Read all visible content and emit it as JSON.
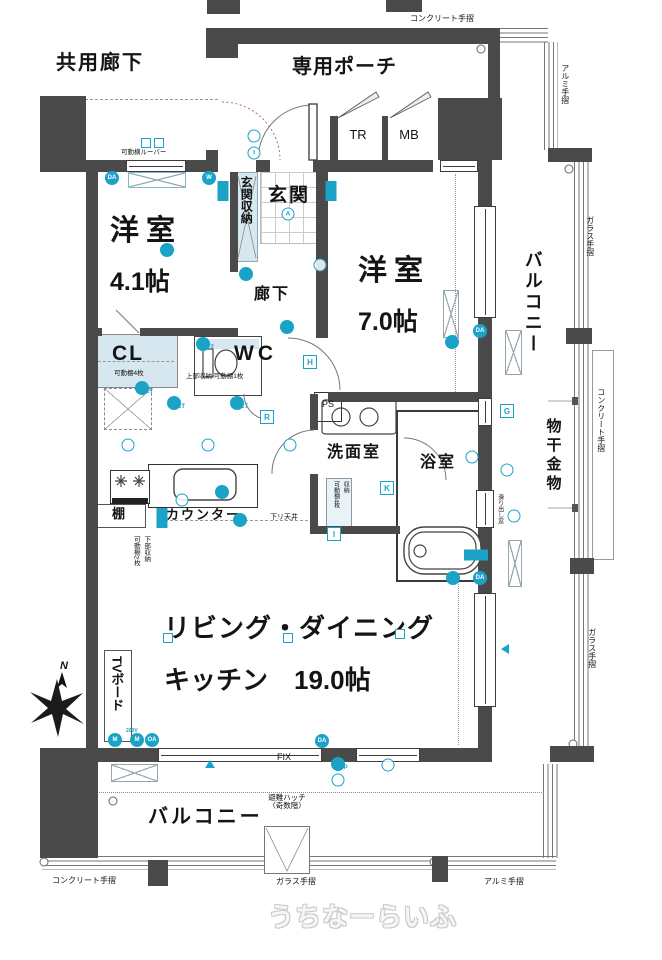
{
  "labels": {
    "shared_corridor": "共用廊下",
    "private_porch": "専用ポーチ",
    "tr": "TR",
    "mb": "MB",
    "entrance": "玄関",
    "entrance_storage": "玄関収納",
    "room1_line1": "洋室",
    "room1_line2": "4.1帖",
    "corridor": "廊下",
    "room2_line1": "洋室",
    "room2_line2": "7.0帖",
    "balcony_right": "バルコニー",
    "cl": "CL",
    "cl_note": "可動棚4枚",
    "wc": "WC",
    "wc_note": "上部収納 可動棚1枚",
    "ps": "PS",
    "washroom": "洗面室",
    "bathroom": "浴室",
    "washroom_storage": "収納\n可動棚4枚",
    "shelf": "棚",
    "counter": "カウンター",
    "dropped_ceiling": "下リ天井",
    "counter_storage": "下部収納\n可動棚2枚",
    "ldk_line1": "リビング・ダイニング",
    "ldk_line2": "キッチン　19.0帖",
    "tv_board": "TVボード",
    "balcony_bottom": "バルコニー",
    "hatch": "避難ハッチ\n（奇数階）",
    "laundry_hardware": "物干金物",
    "louver_note": "可動横ルーバー",
    "sliding_window_note": "滑り出し窓",
    "fix": "FIX",
    "v200": "200V",
    "compass_n": "N",
    "rail_concrete_top": "コンクリート手摺",
    "rail_alumi_right": "アルミ手摺",
    "rail_glass_right_upper": "ガラス手摺",
    "rail_concrete_right": "コンクリート手摺",
    "rail_glass_right_lower": "ガラス手摺",
    "rail_concrete_bottom": "コンクリート手摺",
    "rail_glass_bottom": "ガラス手摺",
    "rail_alumi_bottom": "アルミ手摺",
    "watermark": "うちなーらいふ"
  },
  "colors": {
    "wall": "#4a4a4a",
    "accent": "#1ba3c7",
    "closet_fill": "#d7e7f0",
    "rail": "#777777"
  },
  "icons": [
    {
      "t": "c",
      "x": 112,
      "y": 178,
      "txt": "DA"
    },
    {
      "t": "x",
      "x": 146,
      "y": 143
    },
    {
      "t": "x",
      "x": 159,
      "y": 143
    },
    {
      "t": "c",
      "x": 209,
      "y": 178,
      "txt": "W"
    },
    {
      "t": "b",
      "x": 223,
      "y": 191
    },
    {
      "t": "o",
      "x": 254,
      "y": 136
    },
    {
      "t": "o",
      "x": 254,
      "y": 153,
      "txt": "I"
    },
    {
      "t": "o",
      "x": 288,
      "y": 214,
      "txt": "A"
    },
    {
      "t": "b",
      "x": 331,
      "y": 191
    },
    {
      "t": "c",
      "x": 167,
      "y": 250
    },
    {
      "t": "o",
      "x": 320,
      "y": 265
    },
    {
      "t": "c",
      "x": 287,
      "y": 327
    },
    {
      "t": "s",
      "x": 310,
      "y": 362,
      "txt": "H"
    },
    {
      "t": "c",
      "x": 203,
      "y": 344,
      "sub": "2ET"
    },
    {
      "t": "c",
      "x": 142,
      "y": 388,
      "sub": "2ET"
    },
    {
      "t": "c",
      "x": 174,
      "y": 403,
      "sub": "2ET"
    },
    {
      "t": "c",
      "x": 237,
      "y": 403,
      "sub": "2ET"
    },
    {
      "t": "s",
      "x": 267,
      "y": 417,
      "txt": "R"
    },
    {
      "t": "s",
      "x": 387,
      "y": 488,
      "txt": "K"
    },
    {
      "t": "s",
      "x": 334,
      "y": 534,
      "txt": "I"
    },
    {
      "t": "s",
      "x": 507,
      "y": 411,
      "txt": "G"
    },
    {
      "t": "c",
      "x": 480,
      "y": 331,
      "txt": "DA"
    },
    {
      "t": "c",
      "x": 452,
      "y": 342
    },
    {
      "t": "o",
      "x": 472,
      "y": 457
    },
    {
      "t": "o",
      "x": 507,
      "y": 470
    },
    {
      "t": "o",
      "x": 514,
      "y": 516
    },
    {
      "t": "c",
      "x": 246,
      "y": 274
    },
    {
      "t": "bh",
      "x": 476,
      "y": 555
    },
    {
      "t": "c",
      "x": 453,
      "y": 578
    },
    {
      "t": "c",
      "x": 480,
      "y": 578,
      "txt": "DA"
    },
    {
      "t": "tri-l",
      "x": 505,
      "y": 649
    },
    {
      "t": "c",
      "x": 115,
      "y": 740,
      "txt": "M"
    },
    {
      "t": "c",
      "x": 137,
      "y": 740,
      "txt": "M"
    },
    {
      "t": "c",
      "x": 152,
      "y": 740,
      "txt": "OA"
    },
    {
      "t": "c",
      "x": 322,
      "y": 741,
      "txt": "DA"
    },
    {
      "t": "tri",
      "x": 210,
      "y": 764
    },
    {
      "t": "c",
      "x": 338,
      "y": 764,
      "sub": "WP"
    },
    {
      "t": "o",
      "x": 338,
      "y": 780
    },
    {
      "t": "o",
      "x": 388,
      "y": 765
    },
    {
      "t": "x",
      "x": 168,
      "y": 638
    },
    {
      "t": "x",
      "x": 288,
      "y": 638
    },
    {
      "t": "x",
      "x": 400,
      "y": 634
    },
    {
      "t": "o",
      "x": 128,
      "y": 445
    },
    {
      "t": "o",
      "x": 208,
      "y": 445
    },
    {
      "t": "o",
      "x": 290,
      "y": 445
    },
    {
      "t": "o",
      "x": 182,
      "y": 500
    },
    {
      "t": "c",
      "x": 222,
      "y": 492
    },
    {
      "t": "b",
      "x": 162,
      "y": 518
    },
    {
      "t": "c",
      "x": 240,
      "y": 520
    },
    {
      "t": "post",
      "x": 481,
      "y": 49
    },
    {
      "t": "post",
      "x": 569,
      "y": 169
    },
    {
      "t": "post",
      "x": 573,
      "y": 744
    },
    {
      "t": "post",
      "x": 113,
      "y": 801
    },
    {
      "t": "post",
      "x": 44,
      "y": 862
    },
    {
      "t": "post",
      "x": 434,
      "y": 862
    }
  ]
}
